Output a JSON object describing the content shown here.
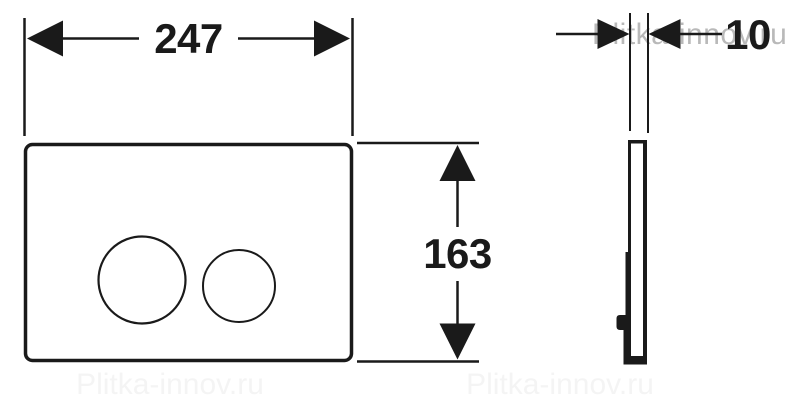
{
  "dimensions": {
    "width": {
      "value": "247"
    },
    "height": {
      "value": "163"
    },
    "thickness": {
      "value": "10"
    }
  },
  "watermark": {
    "text": "Plitka-innov.ru",
    "color": "#b9b9b9"
  },
  "colors": {
    "ink": "#1a1a1a",
    "background": "#ffffff"
  }
}
